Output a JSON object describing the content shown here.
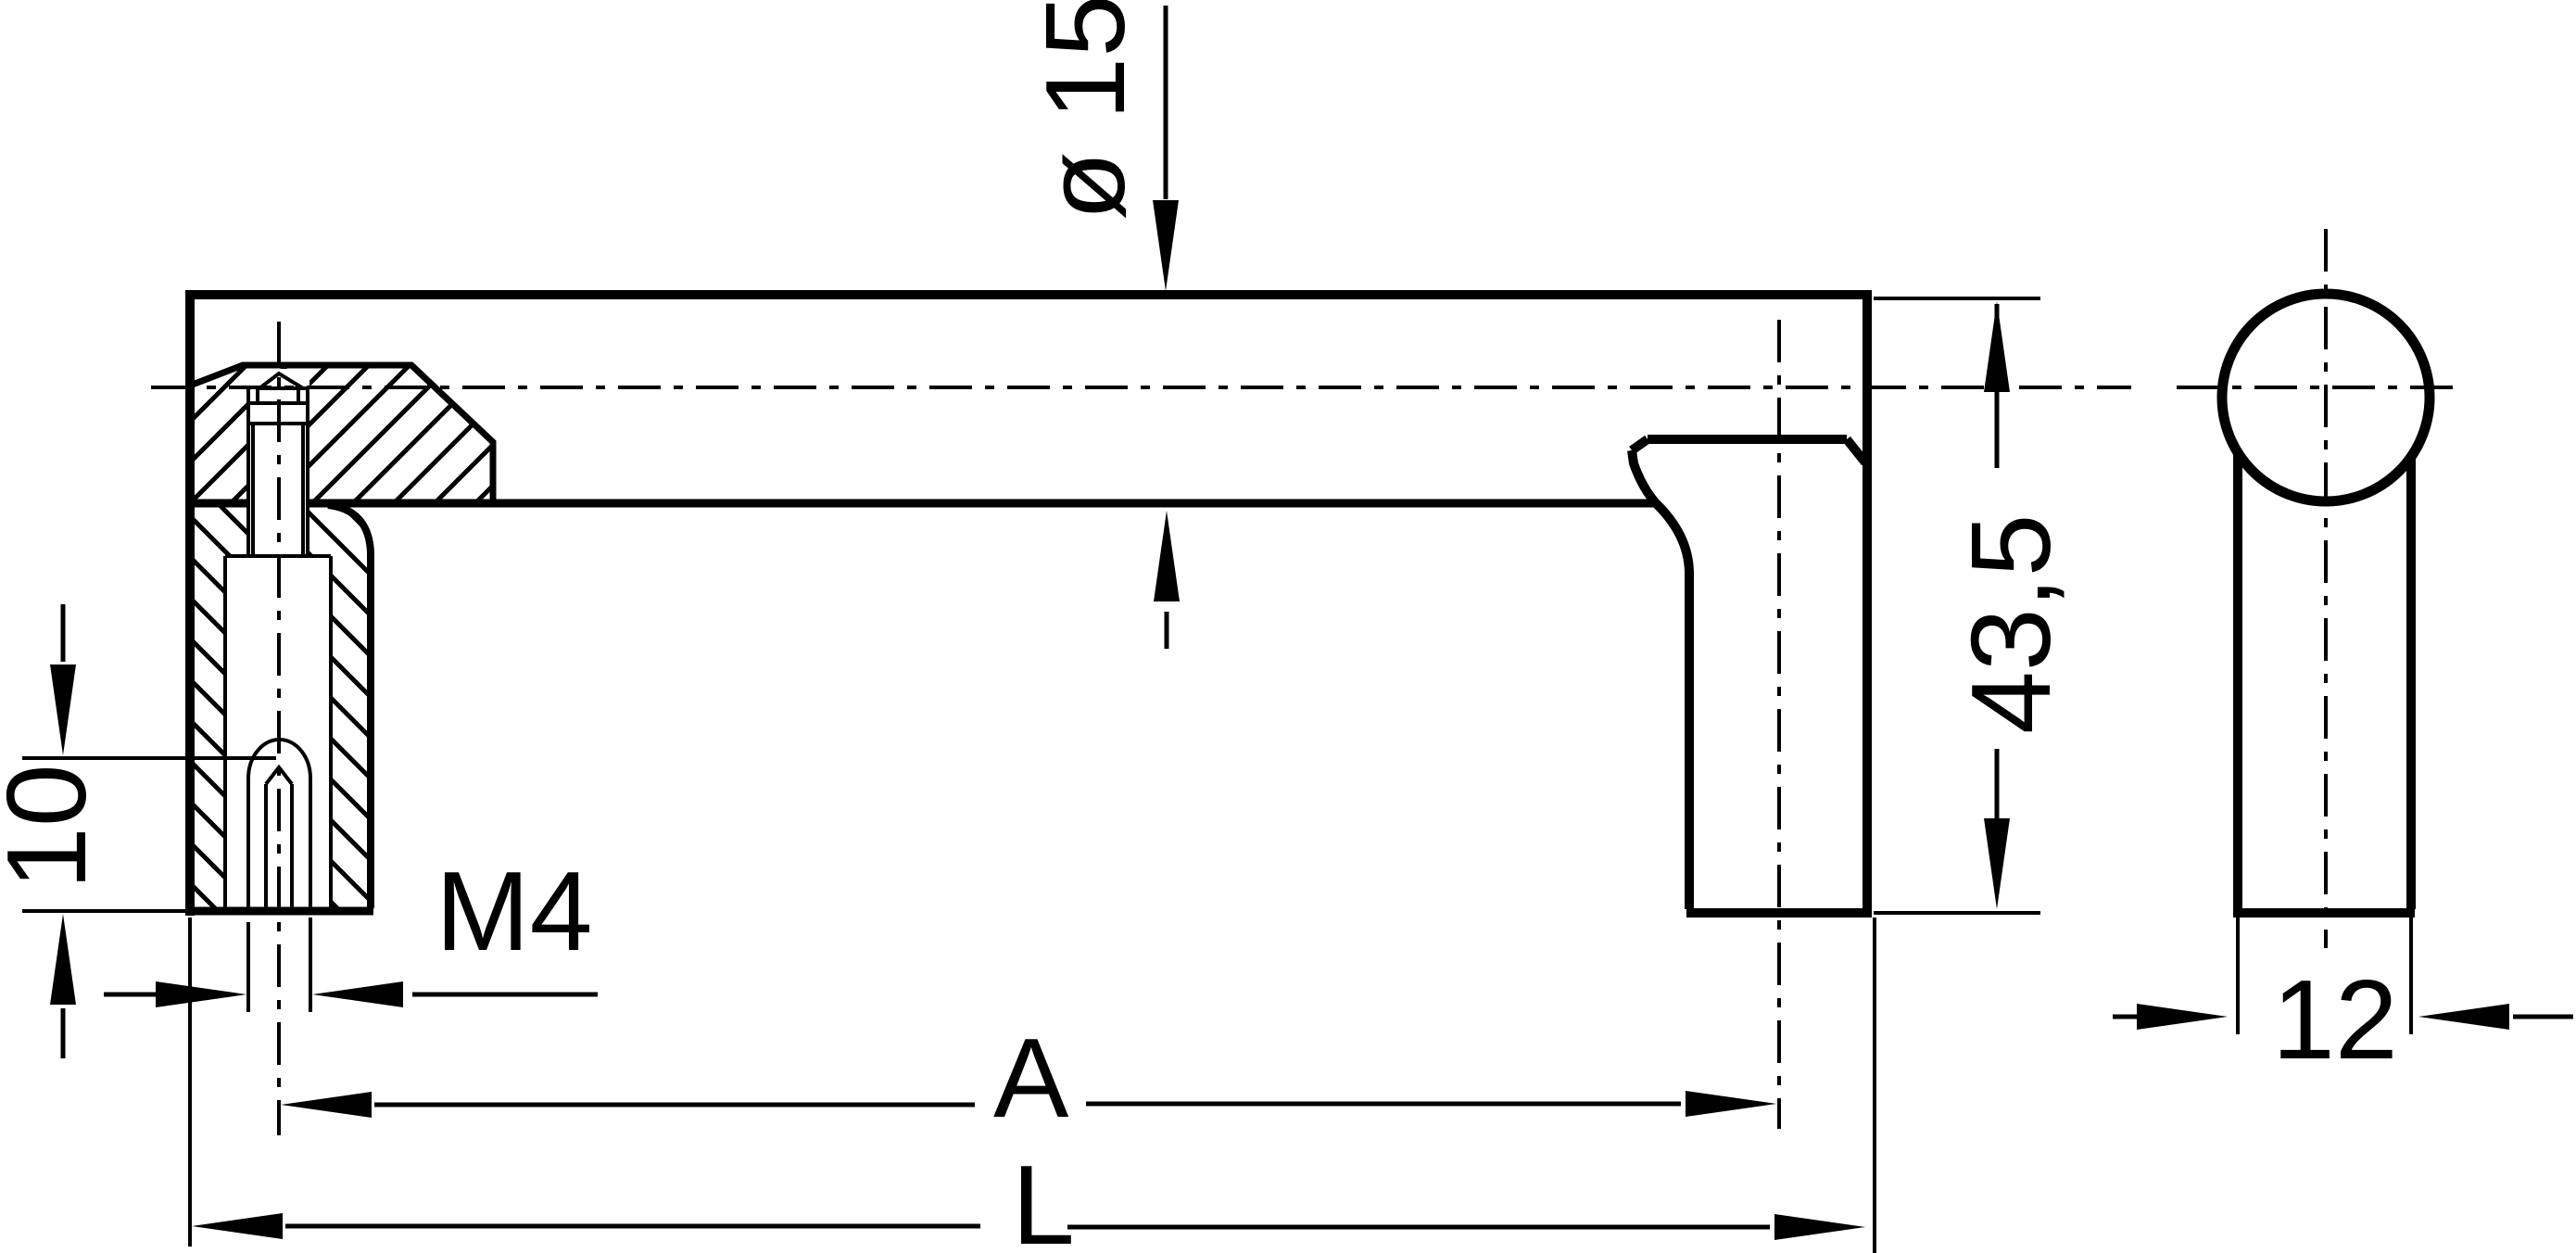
{
  "drawing": {
    "title": "handle-technical-drawing",
    "colors": {
      "line": "#000000",
      "background": "#ffffff"
    },
    "front_view": {
      "dim_diameter": "ø 15",
      "dim_height": "43,5",
      "dim_depth": "10",
      "dim_thread": "M4",
      "dim_hole_spacing": "A",
      "dim_overall_length": "L"
    },
    "side_view": {
      "dim_width": "12"
    }
  }
}
